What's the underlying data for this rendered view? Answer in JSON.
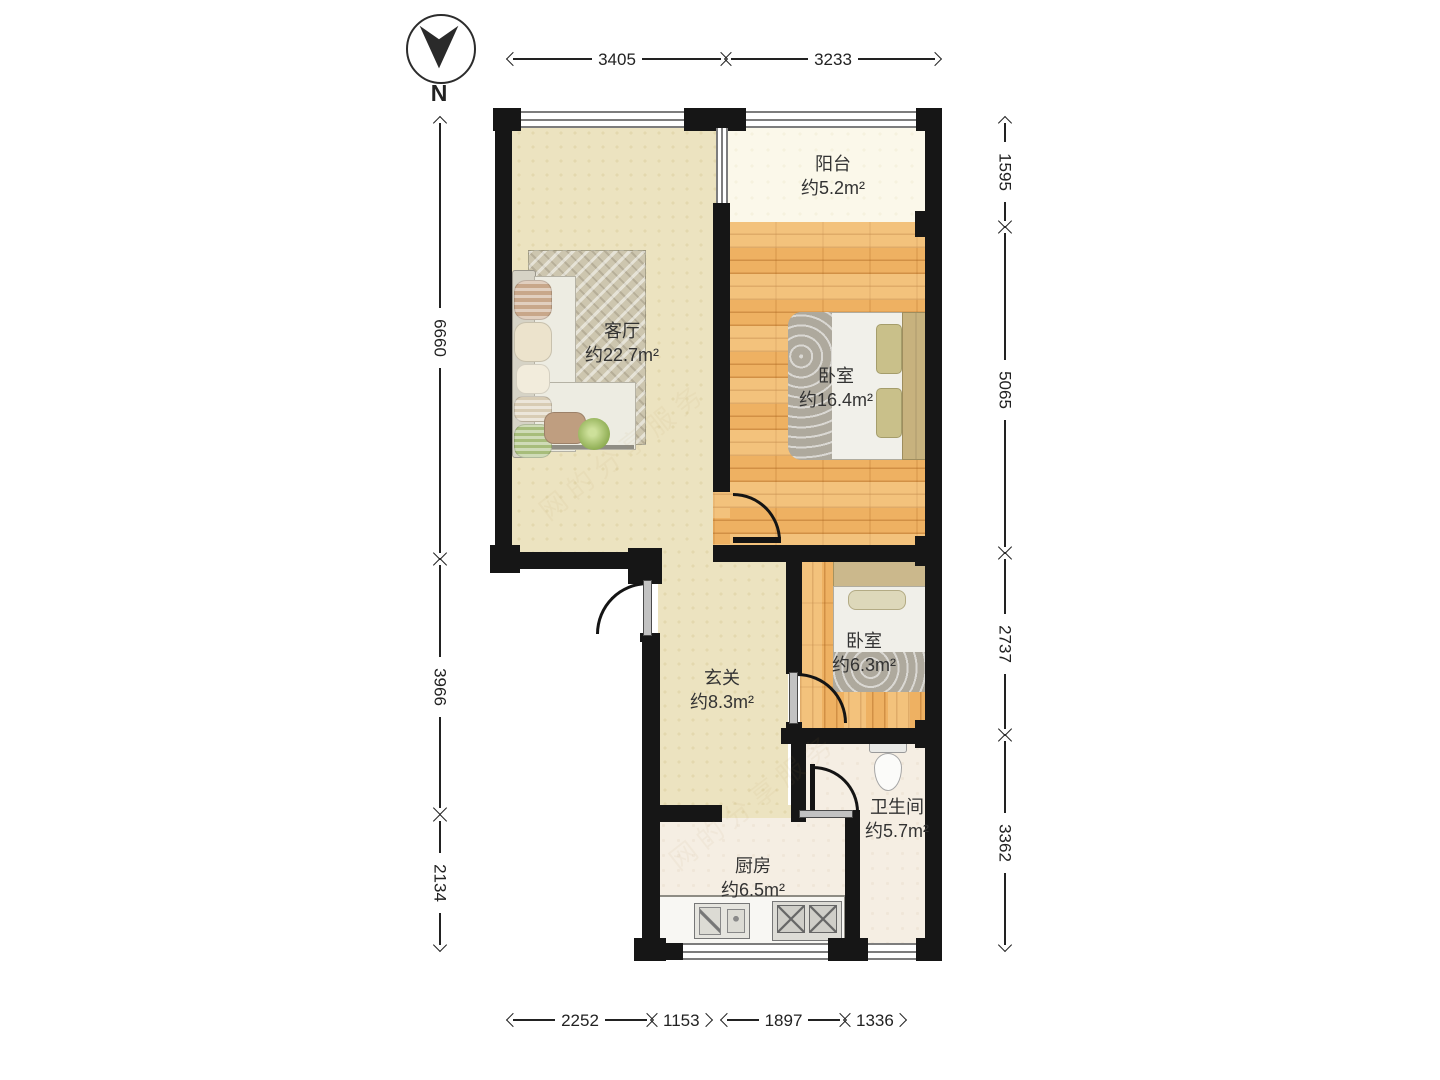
{
  "compass": {
    "label": "N"
  },
  "rooms": [
    {
      "id": "balcony",
      "name": "阳台",
      "area": "约5.2m²"
    },
    {
      "id": "living-room",
      "name": "客厅",
      "area": "约22.7m²"
    },
    {
      "id": "bedroom-main",
      "name": "卧室",
      "area": "约16.4m²"
    },
    {
      "id": "bedroom-small",
      "name": "卧室",
      "area": "约6.3m²"
    },
    {
      "id": "entry-hall",
      "name": "玄关",
      "area": "约8.3m²"
    },
    {
      "id": "bathroom",
      "name": "卫生间",
      "area": "约5.7m²"
    },
    {
      "id": "kitchen",
      "name": "厨房",
      "area": "约6.5m²"
    }
  ],
  "dimensions": {
    "top": [
      "3405",
      "3233"
    ],
    "bottom": [
      "2252",
      "1153",
      "1897",
      "1336"
    ],
    "left": [
      "6660",
      "3966",
      "2134"
    ],
    "right": [
      "1595",
      "5065",
      "2737",
      "3362"
    ]
  },
  "watermark": "网的分享服务",
  "colors": {
    "wall": "#161616",
    "wood": "#eeb162",
    "cream": "#ece3c0",
    "balcony": "#fbf8ea",
    "tile": "#f5eee3",
    "dim": "#222222",
    "label": "#333333"
  }
}
